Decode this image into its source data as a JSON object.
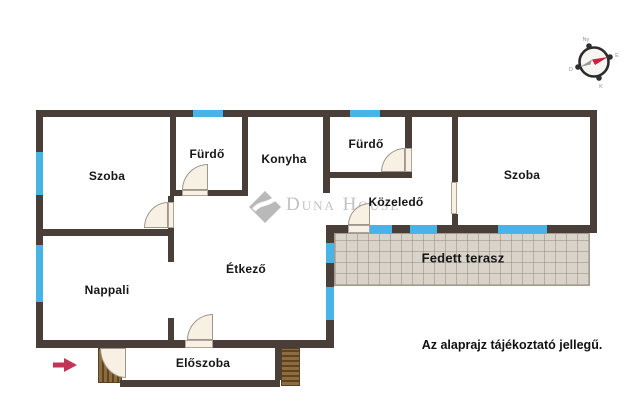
{
  "rooms": {
    "szoba_left": "Szoba",
    "furdo_left": "Fürdő",
    "konyha": "Konyha",
    "furdo_right": "Fürdő",
    "szoba_right": "Szoba",
    "kozeledo": "Közeledő",
    "nappali": "Nappali",
    "etkezo": "Étkező",
    "fedett_terasz": "Fedett terasz",
    "eloszoba": "Előszoba"
  },
  "disclaimer": "Az alaprajz tájékoztató jellegű.",
  "watermark": "Duna House",
  "compass": {
    "north": "É",
    "east": "K",
    "south": "D",
    "west": "Ny"
  },
  "colors": {
    "wall": "#4a3f38",
    "window": "#47b4e8",
    "door": "#f8f0e2",
    "terrace": "#d9d3ca",
    "wood": "#8f6b40",
    "wood_dark": "#5f451f",
    "arrow": "#c23557",
    "watermark_gray": "#c2c2c2",
    "label": "#151515"
  }
}
